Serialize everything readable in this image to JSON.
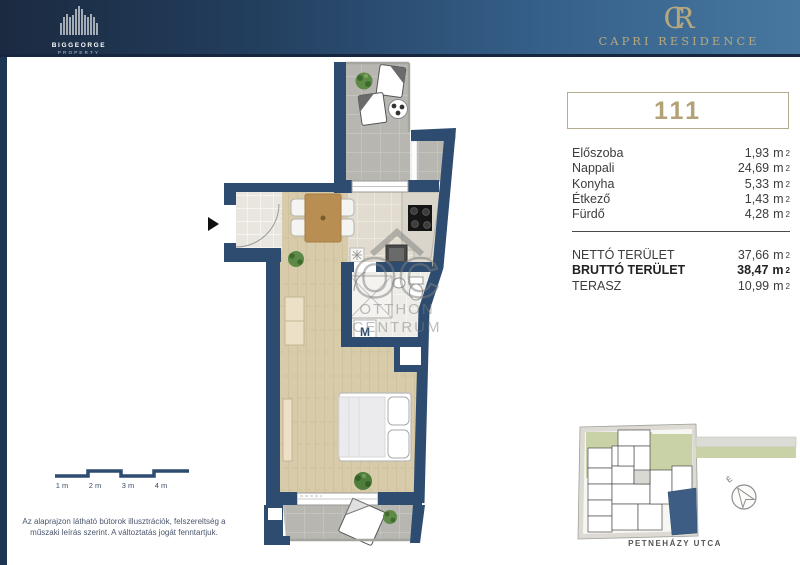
{
  "header": {
    "brand_left": {
      "name": "BIGGEORGE",
      "sub": "PROPERTY"
    },
    "brand_right": {
      "monogram_c": "C",
      "monogram_r": "R",
      "name": "CAPRI RESIDENCE"
    }
  },
  "panel": {
    "apartment_number": "111",
    "unit": "m",
    "unit_sup": "2",
    "rooms": [
      {
        "label": "Előszoba",
        "value": "1,93"
      },
      {
        "label": "Nappali",
        "value": "24,69"
      },
      {
        "label": "Konyha",
        "value": "5,33"
      },
      {
        "label": "Étkező",
        "value": "1,43"
      },
      {
        "label": "Fürdő",
        "value": "4,28"
      }
    ],
    "totals": [
      {
        "label": "NETTÓ TERÜLET",
        "value": "37,66"
      },
      {
        "label": "BRUTTÓ TERÜLET",
        "value": "38,47"
      },
      {
        "label": "TERASZ",
        "value": "10,99"
      }
    ]
  },
  "floorplan": {
    "washer_label": "M",
    "watermark": {
      "monogram": "OC",
      "line1": "OTTHON",
      "line2": "CENTRUM"
    }
  },
  "scalebar": {
    "labels": [
      "1 m",
      "2 m",
      "3 m",
      "4 m"
    ]
  },
  "disclaimer": {
    "line1": "Az alaprajzon látható bútorok illusztrációk, felszereltség a",
    "line2": "műszaki leírás szerint. A változtatás jogát fenntartjuk."
  },
  "siteplan": {
    "street": "PETNEHÁZY UTCA",
    "north": "É"
  },
  "colors": {
    "wall_navy": "#2d4c70",
    "gold": "#b3a277",
    "header_dark": "#1b2a40",
    "header_light": "#47779f"
  }
}
